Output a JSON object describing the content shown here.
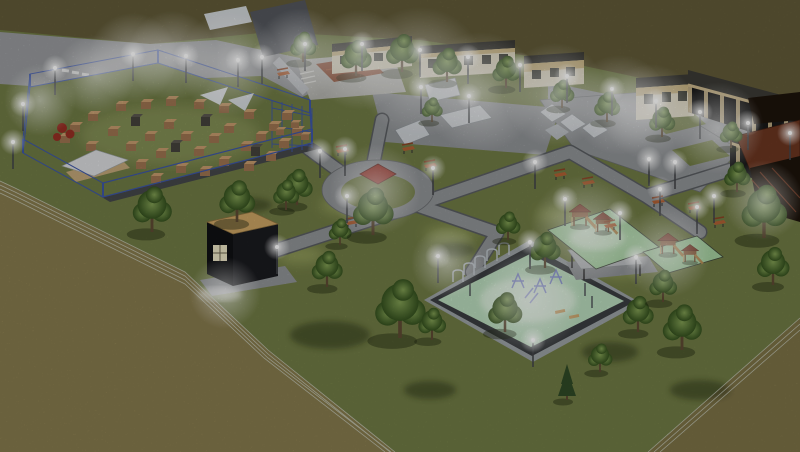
{
  "colors": {
    "field_top": "#615a38",
    "field_fore": "#867a4d",
    "field_br": "#7b7146",
    "grass": "#6f7a44",
    "grass_light": "#a8b26a",
    "road": "#97999c",
    "path": "#8f9295",
    "curb": "#595c60",
    "ramp": "#c9cdd1",
    "court": "#8a4a30",
    "wall_light": "#d9d2bb",
    "roof_dark": "#3b3a35",
    "parapet": "#c6b180",
    "garage": "#191919",
    "pillar": "#c8b489",
    "mint": "#b7d9ba",
    "play_green": "#a4cf9f",
    "wood": "#8a5a36",
    "roof_red": "#7c3b28",
    "kiosk": "#101114",
    "kiosk_top": "#c9a263",
    "window_lit": "#e9e2c2",
    "pavilion": "#1c130b",
    "pavilion_roof": "#6a3520",
    "fence": "#3d56a6",
    "red_obj": "#962f24",
    "box": "#9c7350",
    "box_top": "#c49a6c",
    "box_dark": "#45423c",
    "tree_hi": "#7f9c52",
    "tree_lo": "#35511f",
    "trunk": "#5d4a33",
    "pine": "#2f4a26",
    "shadow": "#1f2611",
    "bench": "#b06034",
    "post": "#43464a",
    "wire": "#ccd2c6",
    "glow": "#ffffff"
  },
  "scene": {
    "trees": [
      [
        152,
        232,
        1.2
      ],
      [
        237,
        222,
        1.1
      ],
      [
        297,
        205,
        0.95
      ],
      [
        327,
        287,
        0.95
      ],
      [
        340,
        245,
        0.7
      ],
      [
        400,
        338,
        1.55
      ],
      [
        505,
        332,
        1.05
      ],
      [
        373,
        235,
        1.25
      ],
      [
        286,
        210,
        0.8
      ],
      [
        508,
        240,
        0.75
      ],
      [
        545,
        268,
        0.95
      ],
      [
        682,
        350,
        1.2
      ],
      [
        638,
        332,
        0.95
      ],
      [
        600,
        372,
        0.75
      ],
      [
        432,
        340,
        0.85
      ],
      [
        764,
        238,
        1.4
      ],
      [
        773,
        285,
        1.0
      ],
      [
        663,
        302,
        0.85
      ],
      [
        737,
        192,
        0.8
      ],
      [
        303,
        62,
        0.8
      ],
      [
        356,
        76,
        0.95
      ],
      [
        402,
        72,
        1.0
      ],
      [
        447,
        82,
        0.9
      ],
      [
        506,
        88,
        0.85
      ],
      [
        562,
        108,
        0.75
      ],
      [
        607,
        122,
        0.8
      ],
      [
        662,
        137,
        0.8
      ],
      [
        731,
        148,
        0.7
      ],
      [
        432,
        122,
        0.65
      ]
    ],
    "pines": [
      [
        567,
        400,
        1.0
      ]
    ],
    "lamps": [
      [
        23,
        104
      ],
      [
        55,
        68
      ],
      [
        13,
        142
      ],
      [
        133,
        54
      ],
      [
        186,
        56
      ],
      [
        238,
        60
      ],
      [
        262,
        57
      ],
      [
        305,
        44
      ],
      [
        362,
        44
      ],
      [
        420,
        50
      ],
      [
        468,
        57
      ],
      [
        520,
        65
      ],
      [
        567,
        76
      ],
      [
        612,
        89
      ],
      [
        656,
        101
      ],
      [
        700,
        112
      ],
      [
        748,
        123
      ],
      [
        790,
        133
      ],
      [
        421,
        87
      ],
      [
        469,
        96
      ],
      [
        320,
        151
      ],
      [
        345,
        149
      ],
      [
        347,
        196
      ],
      [
        277,
        247
      ],
      [
        433,
        168
      ],
      [
        535,
        162
      ],
      [
        649,
        159
      ],
      [
        675,
        162
      ],
      [
        714,
        196
      ],
      [
        660,
        189
      ],
      [
        565,
        199
      ],
      [
        620,
        213
      ],
      [
        697,
        207
      ],
      [
        438,
        256
      ],
      [
        530,
        242
      ],
      [
        636,
        257
      ],
      [
        533,
        340
      ]
    ],
    "glows": [
      [
        133,
        58,
        45
      ],
      [
        172,
        56,
        45
      ],
      [
        230,
        64,
        52
      ],
      [
        300,
        54,
        46
      ],
      [
        360,
        60,
        50
      ],
      [
        420,
        72,
        65
      ],
      [
        480,
        92,
        60
      ],
      [
        555,
        95,
        52
      ],
      [
        620,
        105,
        50
      ],
      [
        650,
        112,
        48
      ],
      [
        718,
        128,
        46
      ],
      [
        763,
        200,
        40
      ],
      [
        375,
        190,
        46
      ],
      [
        585,
        230,
        55
      ],
      [
        665,
        252,
        46
      ],
      [
        530,
        300,
        52
      ],
      [
        225,
        293,
        36
      ],
      [
        447,
        262,
        36
      ],
      [
        95,
        75,
        40
      ],
      [
        40,
        100,
        36
      ]
    ],
    "boxes": [
      [
        75,
        132
      ],
      [
        93,
        121
      ],
      [
        113,
        136
      ],
      [
        91,
        151
      ],
      [
        131,
        151
      ],
      [
        150,
        141
      ],
      [
        169,
        129
      ],
      [
        186,
        141
      ],
      [
        161,
        158
      ],
      [
        141,
        169
      ],
      [
        111,
        168
      ],
      [
        199,
        156
      ],
      [
        214,
        143
      ],
      [
        229,
        133
      ],
      [
        246,
        151
      ],
      [
        261,
        141
      ],
      [
        224,
        166
      ],
      [
        205,
        176
      ],
      [
        249,
        171
      ],
      [
        271,
        161
      ],
      [
        121,
        111
      ],
      [
        146,
        109
      ],
      [
        171,
        106
      ],
      [
        199,
        109
      ],
      [
        224,
        113
      ],
      [
        249,
        119
      ],
      [
        274,
        131
      ],
      [
        284,
        148
      ],
      [
        181,
        173
      ],
      [
        156,
        183
      ],
      [
        97,
        166
      ],
      [
        65,
        143
      ],
      [
        287,
        120
      ],
      [
        297,
        136
      ],
      [
        280,
        135,
        0.8
      ],
      [
        295,
        128,
        0.8
      ],
      [
        305,
        140,
        0.8
      ]
    ],
    "boxes_dark": [
      [
        136,
        126
      ],
      [
        206,
        126
      ],
      [
        256,
        156
      ],
      [
        176,
        152
      ]
    ],
    "benches": [
      [
        342,
        152
      ],
      [
        408,
        150
      ],
      [
        352,
        224
      ],
      [
        560,
        176
      ],
      [
        588,
        184
      ],
      [
        658,
        203
      ],
      [
        610,
        227
      ],
      [
        694,
        209
      ],
      [
        719,
        224
      ],
      [
        283,
        75
      ],
      [
        430,
        167
      ]
    ],
    "towers": [
      [
        580,
        226,
        1.0
      ],
      [
        603,
        232,
        0.9
      ],
      [
        668,
        254,
        0.95
      ],
      [
        690,
        262,
        0.8
      ]
    ],
    "shadows": [
      [
        330,
        335,
        40,
        14
      ],
      [
        430,
        390,
        26,
        9
      ],
      [
        455,
        250,
        20,
        7
      ],
      [
        610,
        352,
        28,
        10
      ],
      [
        700,
        390,
        30,
        10
      ],
      [
        250,
        205,
        22,
        7
      ],
      [
        560,
        310,
        18,
        6
      ],
      [
        480,
        300,
        16,
        6
      ]
    ],
    "lights": [
      [
        350,
        205,
        30,
        10
      ],
      [
        450,
        235,
        26,
        9
      ],
      [
        300,
        255,
        24,
        9
      ],
      [
        560,
        215,
        24,
        8
      ],
      [
        470,
        300,
        20,
        8
      ],
      [
        620,
        270,
        22,
        8
      ],
      [
        160,
        140,
        30,
        10
      ],
      [
        230,
        150,
        24,
        8
      ]
    ]
  }
}
